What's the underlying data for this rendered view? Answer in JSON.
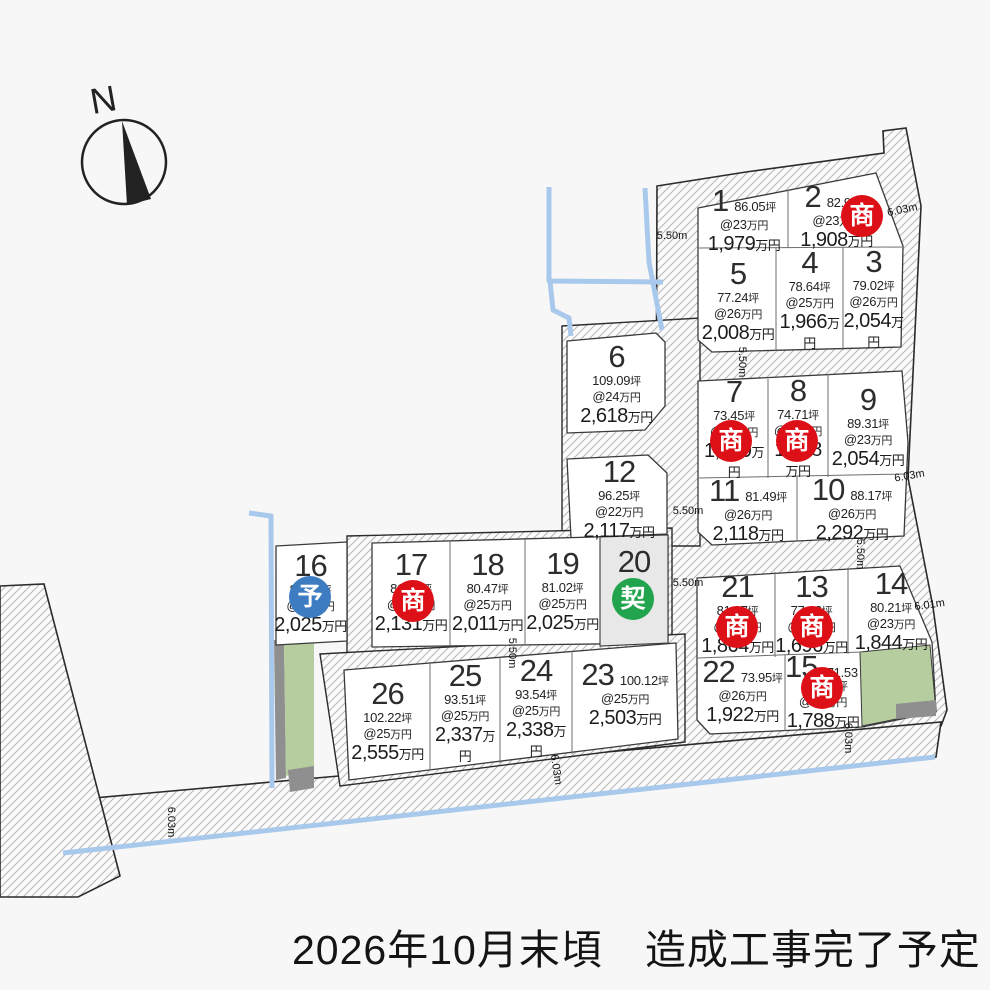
{
  "map": {
    "compass_label": "N",
    "caption": "2026年10月末頃　造成工事完了予定",
    "badge_labels": {
      "negotiating": "商",
      "reserved": "予",
      "contracted": "契"
    },
    "colors": {
      "negotiating": "#dc1016",
      "reserved": "#3d7cc1",
      "contracted": "#21a44d",
      "water": "#a9c9ec",
      "green_area": "#b6cda0",
      "shadow_gray": "#8f8f8f",
      "land": "#ffffff",
      "sold_land": "#e8e8e8",
      "outline": "#2b2b2b",
      "hatch_line": "#b9b9b9"
    },
    "dimensions": [
      {
        "label": "5.50m",
        "x": 672,
        "y": 239,
        "rot": 0
      },
      {
        "label": "6.03m",
        "x": 903,
        "y": 213,
        "rot": -12
      },
      {
        "label": "5.50m",
        "x": 739,
        "y": 362,
        "rot": 90
      },
      {
        "label": "6.03m",
        "x": 910,
        "y": 479,
        "rot": -10
      },
      {
        "label": "5.50m",
        "x": 688,
        "y": 514,
        "rot": 0
      },
      {
        "label": "5.50m",
        "x": 857,
        "y": 554,
        "rot": 90
      },
      {
        "label": "5.50m",
        "x": 688,
        "y": 586,
        "rot": 0
      },
      {
        "label": "6.01m",
        "x": 930,
        "y": 608,
        "rot": -8
      },
      {
        "label": "5.50m",
        "x": 509,
        "y": 653,
        "rot": 90
      },
      {
        "label": "6.03m",
        "x": 845,
        "y": 738,
        "rot": 90
      },
      {
        "label": "6.03m",
        "x": 553,
        "y": 770,
        "rot": 82
      },
      {
        "label": "6.03m",
        "x": 168,
        "y": 822,
        "rot": 90
      }
    ],
    "lots": [
      {
        "no": "1",
        "area": "86.05坪",
        "rate": "@23万円",
        "price": "1,979万円",
        "status": null,
        "layout": "row",
        "x": 700,
        "y": 190,
        "w": 88,
        "h": 58
      },
      {
        "no": "2",
        "area": "82.96坪",
        "rate": "@23万円",
        "price": "1,908万円",
        "status": "negotiating",
        "layout": "row",
        "x": 788,
        "y": 184,
        "w": 97,
        "h": 62,
        "bx": 862,
        "by": 216
      },
      {
        "no": "3",
        "area": "79.02坪",
        "rate": "@26万円",
        "price": "2,054万円",
        "status": null,
        "layout": "stack",
        "x": 843,
        "y": 249,
        "w": 61,
        "h": 99
      },
      {
        "no": "4",
        "area": "78.64坪",
        "rate": "@25万円",
        "price": "1,966万円",
        "status": null,
        "layout": "stack",
        "x": 776,
        "y": 250,
        "w": 67,
        "h": 99
      },
      {
        "no": "5",
        "area": "77.24坪",
        "rate": "@26万円",
        "price": "2,008万円",
        "status": null,
        "layout": "stack",
        "x": 700,
        "y": 251,
        "w": 76,
        "h": 99
      },
      {
        "no": "6",
        "area": "109.09坪",
        "rate": "@24万円",
        "price": "2,618万円",
        "status": null,
        "layout": "stack",
        "x": 569,
        "y": 337,
        "w": 95,
        "h": 93
      },
      {
        "no": "7",
        "area": "73.45坪",
        "rate": "@23万円",
        "price": "1,689万円",
        "status": "negotiating",
        "layout": "stack",
        "x": 700,
        "y": 380,
        "w": 68,
        "h": 97,
        "bx": 731,
        "by": 441
      },
      {
        "no": "8",
        "area": "74.71坪",
        "rate": "@21万円",
        "price": "1,568万円",
        "status": "negotiating",
        "layout": "stack",
        "x": 768,
        "y": 378,
        "w": 60,
        "h": 99,
        "bx": 797,
        "by": 441
      },
      {
        "no": "9",
        "area": "89.31坪",
        "rate": "@23万円",
        "price": "2,054万円",
        "status": null,
        "layout": "stack",
        "x": 828,
        "y": 376,
        "w": 80,
        "h": 100
      },
      {
        "no": "10",
        "area": "88.17坪",
        "rate": "@26万円",
        "price": "2,292万円",
        "status": null,
        "layout": "row",
        "x": 797,
        "y": 478,
        "w": 110,
        "h": 60
      },
      {
        "no": "11",
        "area": "81.49坪",
        "rate": "@26万円",
        "price": "2,118万円",
        "status": null,
        "layout": "row",
        "x": 699,
        "y": 480,
        "w": 98,
        "h": 58
      },
      {
        "no": "12",
        "area": "96.25坪",
        "rate": "@22万円",
        "price": "2,117万円",
        "status": null,
        "layout": "stack",
        "x": 570,
        "y": 458,
        "w": 98,
        "h": 80
      },
      {
        "no": "13",
        "area": "77.12坪",
        "rate": "@22万円",
        "price": "1,696万円",
        "status": "negotiating",
        "layout": "stack",
        "x": 775,
        "y": 570,
        "w": 73,
        "h": 86,
        "bx": 812,
        "by": 627
      },
      {
        "no": "14",
        "area": "80.21坪",
        "rate": "@23万円",
        "price": "1,844万円",
        "status": null,
        "layout": "stack",
        "x": 848,
        "y": 568,
        "w": 86,
        "h": 84
      },
      {
        "no": "15",
        "area": "71.53坪",
        "rate": "@25万円",
        "price": "1,788万円",
        "status": "negotiating",
        "layout": "row",
        "x": 785,
        "y": 656,
        "w": 76,
        "h": 70,
        "bx": 822,
        "by": 688
      },
      {
        "no": "16",
        "area": "81.03坪",
        "rate": "@25万円",
        "price": "2,025万円",
        "status": "reserved",
        "layout": "stack",
        "x": 272,
        "y": 545,
        "w": 77,
        "h": 95,
        "bx": 310,
        "by": 597
      },
      {
        "no": "17",
        "area": "81.98坪",
        "rate": "@26万円",
        "price": "2,131万円",
        "status": "negotiating",
        "layout": "stack",
        "x": 372,
        "y": 543,
        "w": 78,
        "h": 97,
        "bx": 413,
        "by": 601
      },
      {
        "no": "18",
        "area": "80.47坪",
        "rate": "@25万円",
        "price": "2,011万円",
        "status": null,
        "layout": "stack",
        "x": 450,
        "y": 542,
        "w": 75,
        "h": 98
      },
      {
        "no": "19",
        "area": "81.02坪",
        "rate": "@25万円",
        "price": "2,025万円",
        "status": null,
        "layout": "stack",
        "x": 525,
        "y": 540,
        "w": 75,
        "h": 100
      },
      {
        "no": "20",
        "area": null,
        "rate": null,
        "price": null,
        "status": "contracted",
        "layout": "stack",
        "x": 600,
        "y": 538,
        "w": 68,
        "h": 102,
        "bx": 633,
        "by": 599
      },
      {
        "no": "21",
        "area": "81.07坪",
        "rate": "@23万円",
        "price": "1,864万円",
        "status": "negotiating",
        "layout": "stack",
        "x": 700,
        "y": 572,
        "w": 75,
        "h": 83,
        "bx": 737,
        "by": 627
      },
      {
        "no": "22",
        "area": "73.95坪",
        "rate": "@26万円",
        "price": "1,922万円",
        "status": null,
        "layout": "row",
        "x": 700,
        "y": 657,
        "w": 85,
        "h": 66
      },
      {
        "no": "23",
        "area": "100.12坪",
        "rate": "@25万円",
        "price": "2,503万円",
        "status": null,
        "layout": "row",
        "x": 574,
        "y": 646,
        "w": 102,
        "h": 95
      },
      {
        "no": "24",
        "area": "93.54坪",
        "rate": "@25万円",
        "price": "2,338万円",
        "status": null,
        "layout": "stack",
        "x": 500,
        "y": 655,
        "w": 72,
        "h": 105
      },
      {
        "no": "25",
        "area": "93.51坪",
        "rate": "@25万円",
        "price": "2,337万円",
        "status": null,
        "layout": "stack",
        "x": 430,
        "y": 660,
        "w": 70,
        "h": 105
      },
      {
        "no": "26",
        "area": "102.22坪",
        "rate": "@25万円",
        "price": "2,555万円",
        "status": null,
        "layout": "stack",
        "x": 345,
        "y": 665,
        "w": 85,
        "h": 110
      }
    ]
  }
}
